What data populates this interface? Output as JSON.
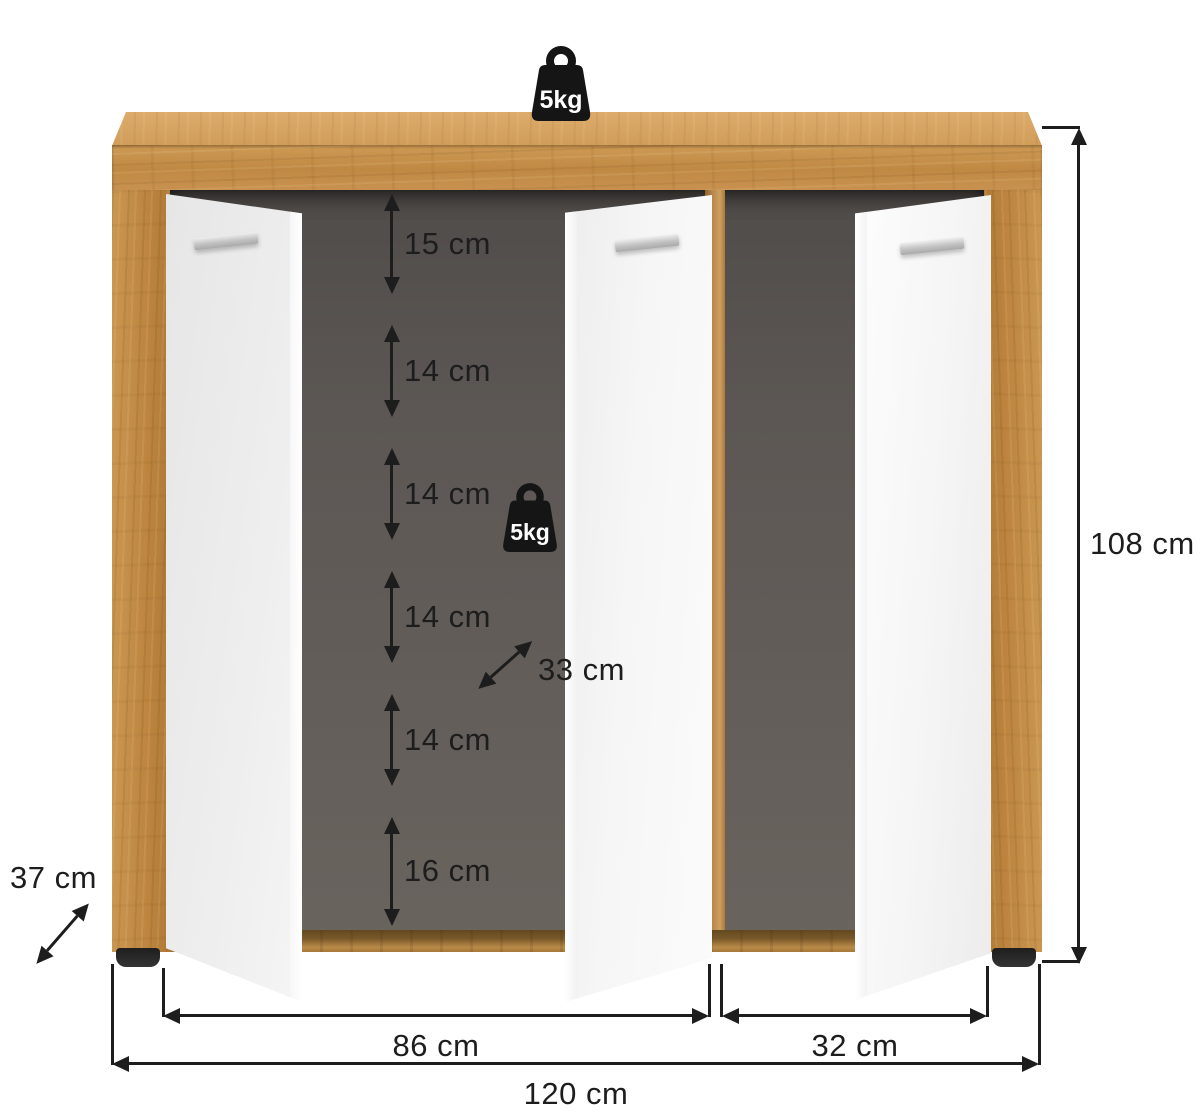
{
  "weights": {
    "top_label": "5kg",
    "shelf_label": "5kg"
  },
  "shelf_gaps": [
    {
      "label": "15 cm"
    },
    {
      "label": "14 cm"
    },
    {
      "label": "14 cm"
    },
    {
      "label": "14 cm"
    },
    {
      "label": "14 cm"
    },
    {
      "label": "16 cm"
    }
  ],
  "dimensions": {
    "shelf_depth": "33 cm",
    "height": "108 cm",
    "cabinet_depth": "37 cm",
    "left_section_width": "86 cm",
    "right_section_width": "32 cm",
    "total_width": "120 cm"
  },
  "colors": {
    "oak": "#c08943",
    "oak_light": "#d8a766",
    "interior_back": "#5c5754",
    "door": "#f1f1f1",
    "handle": "#c4c4c4",
    "dimension_line": "#1d1d1d",
    "foot": "#262626",
    "background": "#ffffff"
  }
}
